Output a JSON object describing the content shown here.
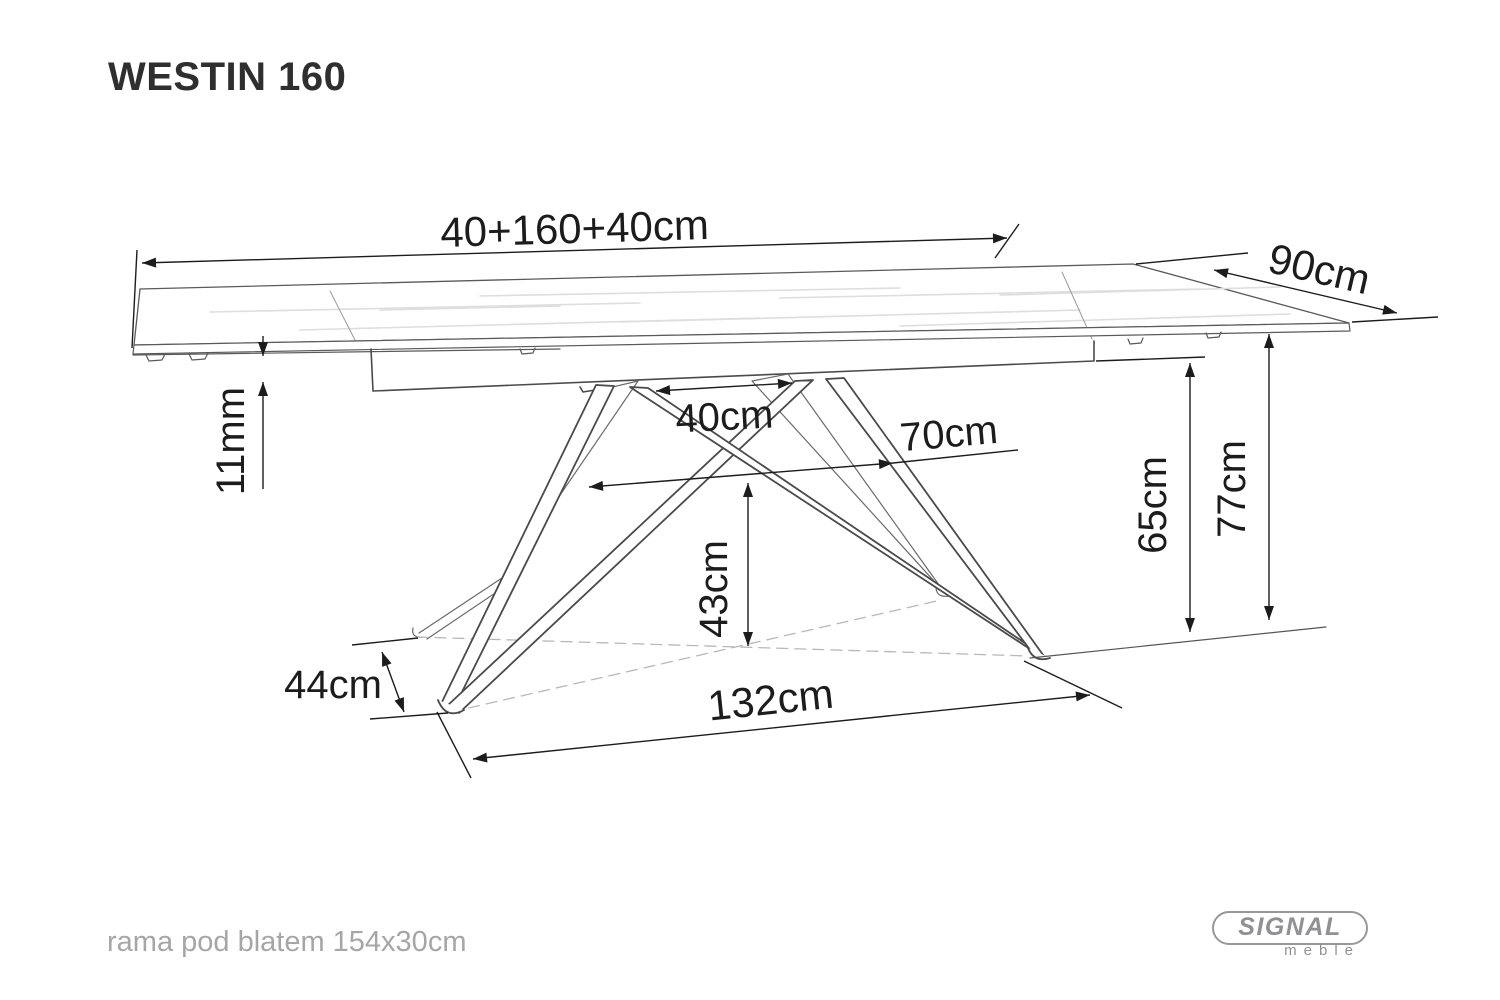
{
  "page": {
    "title": "WESTIN 160",
    "footer_note": "rama pod blatem 154x30cm"
  },
  "dimensions": {
    "total_length": "40+160+40cm",
    "depth": "90cm",
    "top_thickness": "11mm",
    "leg_top_spacing": "40cm",
    "base_mid_width": "70cm",
    "underside_clearance": "65cm",
    "total_height": "77cm",
    "foot_depth": "44cm",
    "base_span": "132cm",
    "brace_height": "43cm"
  },
  "branding": {
    "brand": "SIGNAL",
    "sub_brand": "meble"
  },
  "colors": {
    "background": "#ffffff",
    "drawing_line": "#4a4a4a",
    "dimension_line": "#1c1c1c",
    "label_text": "#1c1c1c",
    "muted_text": "#a6a6a6",
    "logo_gray": "#919193",
    "dashed_line": "#b8b8b8",
    "wood_grain": "#dedede"
  }
}
